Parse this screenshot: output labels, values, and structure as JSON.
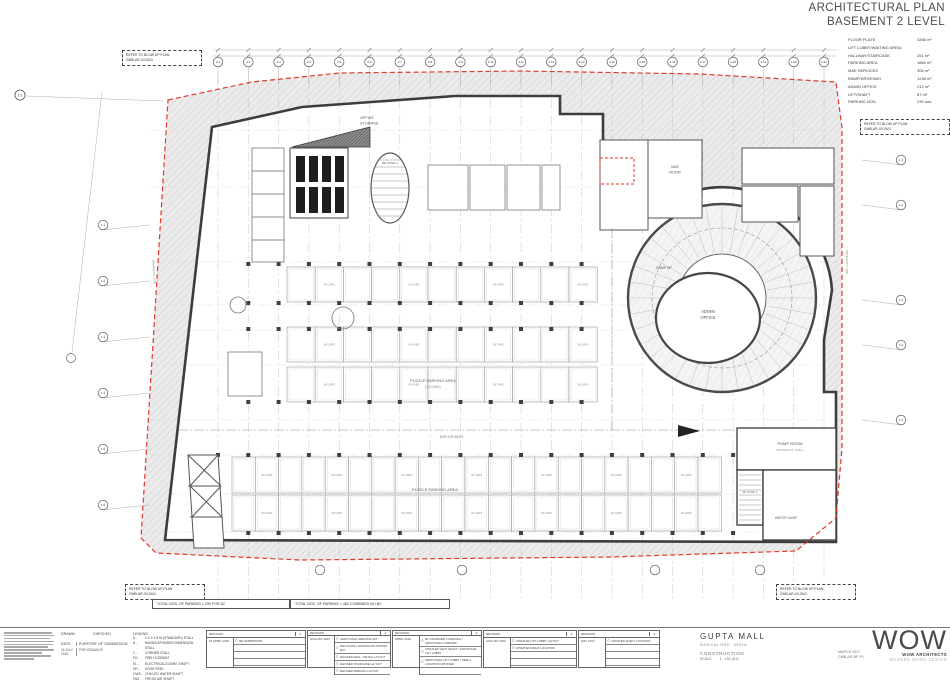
{
  "title": {
    "line1": "ARCHITECTURAL PLAN",
    "line2": "BASEMENT 2 LEVEL"
  },
  "area_table": {
    "rows": [
      {
        "label": "FLOOR PLATE",
        "value": "4266 m²"
      },
      {
        "label": "LIFT LOBBY/WAITING AREA/",
        "value": ""
      },
      {
        "label": "HALLWAY/STAIRCASE",
        "value": "261 m²"
      },
      {
        "label": "PARKING AREA",
        "value": "1860 m²"
      },
      {
        "label": "M&E SERVICES",
        "value": "306 m²"
      },
      {
        "label": "RAMP/DRIVEWAY",
        "value": "1248 m²"
      },
      {
        "label": "ADMIN OFFICE",
        "value": "212 m²"
      },
      {
        "label": "LIFT/SHAFT",
        "value": "87 m²"
      },
      {
        "label": "PARKING NOS.",
        "value": "239 nos."
      }
    ]
  },
  "refer_box": {
    "line1": "REFER TO BLOW UP PLAN",
    "line2": "GMB-AR-XX-BLD"
  },
  "notes": {
    "total_b2": "TOTAL NOS. OF PARKING = 239 FOR B2",
    "total_combined": "TOTAL NOS. OF PARKING = 482 COMBINED B1+B2"
  },
  "plan": {
    "office_storage_1": "OFFICE",
    "office_storage_2": "STORAGE",
    "re_stair_1": "RE STAIR 1",
    "me_room_1": "M&E",
    "me_room_2": "ROOM",
    "ramp_up": "RAMP UP",
    "admin_1": "ADMIN",
    "admin_2": "OFFICE",
    "driveway": "DRIVEWAY",
    "puzzle_area": "PUZZLE PARKING AREA",
    "puzzle_cars": "(40 CARS)",
    "bay_label": "60 CARS",
    "pump_room": "PUMP ROOM",
    "pump_level": "BOTTOM LVL -9.80m",
    "water_sump": "WATER SUMP",
    "re_stair_2": "RE STAIR 2",
    "property_line": "PROPERTY LINE"
  },
  "grid": {
    "corner": "1.0",
    "top": [
      "2.1",
      "2.2",
      "2.3",
      "2.4",
      "2.5",
      "2.6",
      "2.7",
      "2.8",
      "2.9",
      "2.10",
      "2.11",
      "2.12",
      "2.13",
      "2.14",
      "2.15",
      "2.16",
      "2.17",
      "2.18",
      "2.19",
      "2.20",
      "2.21"
    ],
    "left": [
      "1.1",
      "1.2",
      "1.3",
      "1.4",
      "1.5",
      "1.6"
    ],
    "right": [
      "1.1",
      "1.2",
      "1.3",
      "1.4",
      "1.5"
    ]
  },
  "titleblock": {
    "drawn_label": "DRAWN",
    "checked_label": "CHECKED",
    "date_label": "DATE",
    "purpose_label": "PURPOSE OF SUBMISSION",
    "date_value": "16 JULY 2016",
    "purpose_value": "FOR ISSUANCE",
    "legend": {
      "title": "LEGEND",
      "items": [
        {
          "key": "A",
          "desc": "2.4 X 4.8 M (STANDARD) STALL"
        },
        {
          "key": "B",
          "desc": "HANDICAP/WIDER DIMENSION STALL"
        },
        {
          "key": "C",
          "desc": "CORNER STALL"
        },
        {
          "key": "FH",
          "desc": "FIRE HYDRANT"
        },
        {
          "key": "EL",
          "desc": "ELECTRICAL/COMM. SHAFT"
        },
        {
          "key": "HR",
          "desc": "HOSE REEL"
        },
        {
          "key": "CWS",
          "desc": "CHILLED WATER SHAFT"
        },
        {
          "key": "FAS",
          "desc": "FRESH AIR SHAFT"
        }
      ]
    },
    "revision_header": "REVISION",
    "triangle_icon": "△",
    "revisions": [
      {
        "num": "1",
        "date": "16 APRIL 2015",
        "items": [
          "RE-SUBMISSION"
        ],
        "pad": 3
      },
      {
        "num": "2",
        "date": "AUGUST 2015",
        "items": [
          "ADDITIONAL SERVICE LIFT",
          "RELOCATE LOADING/UNLOADING BAY",
          "REVISED MALL / RETAIL LAYOUT",
          "REVISED STAIRCASE LAYOUT",
          "REVISED PARKING LAYOUT"
        ],
        "pad": 0
      },
      {
        "num": "3",
        "date": "APRIL 2016",
        "items": [
          "B1 STANDARD 4 PARKING / ADDITIONAL CARPARK",
          "UPDATED VENT SHAFT / ADDITIONAL LIFT LOBBY",
          "ADDITIONAL LIFT LOBBY / FIRE-X LOCATION UPDATED"
        ],
        "pad": 1
      },
      {
        "num": "4",
        "date": "AUGUST 2016",
        "items": [
          "UPDATED LIFT LOBBY LAYOUT",
          "UPDATED DRAIN LOCATION"
        ],
        "pad": 2
      },
      {
        "num": "5",
        "date": "MAY 2017",
        "items": [
          "UPDATED SHAFT LOCATION"
        ],
        "pad": 3
      }
    ],
    "project": {
      "name": "GUPTA MALL",
      "location": "BANGALORE, INDIA",
      "status": "CONSTRUCTION",
      "scale_label": "SCALE",
      "scale_value": "1 : 150 (A1)",
      "issue_date": "MARCH 2017",
      "drawing_no": "GMB-AR-BP-P1"
    },
    "firm": {
      "logo": "WOW",
      "name": "WOW ARCHITECTS",
      "sub": "WARNER WONG DESIGN"
    }
  },
  "colors": {
    "property_line": "#e03a2b",
    "wall": "#3d3d3d",
    "hatch_bg": "#ebebeb"
  }
}
